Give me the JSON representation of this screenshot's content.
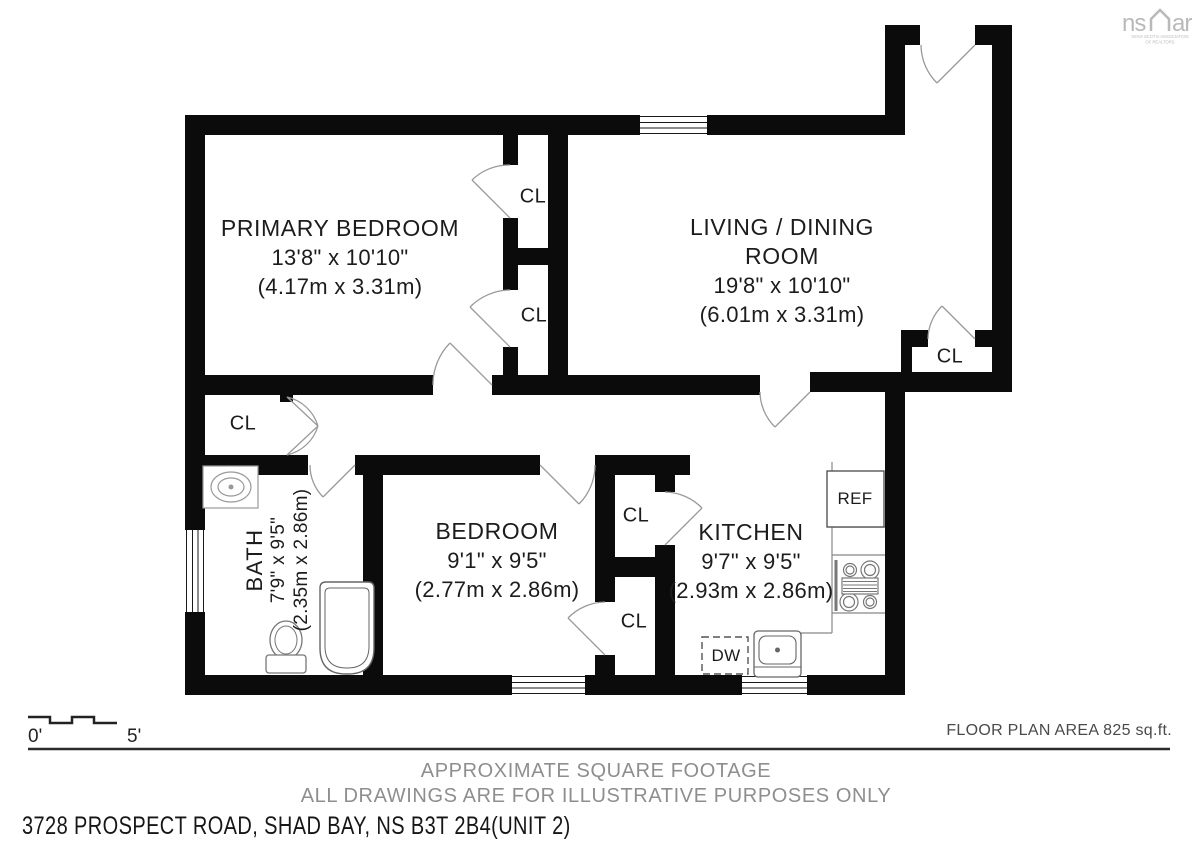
{
  "logo": {
    "left": "ns",
    "right": "ar",
    "sub1": "NOVA SCOTIA ASSOCIATION",
    "sub2": "OF REALTORS"
  },
  "rooms": {
    "primary_bedroom": {
      "name": "PRIMARY BEDROOM",
      "imperial": "13'8\" x 10'10\"",
      "metric": "(4.17m x 3.31m)"
    },
    "living_dining": {
      "name_line1": "LIVING / DINING",
      "name_line2": "ROOM",
      "imperial": "19'8\" x 10'10\"",
      "metric": "(6.01m x 3.31m)"
    },
    "bedroom": {
      "name": "BEDROOM",
      "imperial": "9'1\" x 9'5\"",
      "metric": "(2.77m x 2.86m)"
    },
    "kitchen": {
      "name": "KITCHEN",
      "imperial": "9'7\" x 9'5\"",
      "metric": "(2.93m x 2.86m)"
    },
    "bath": {
      "name": "BATH",
      "imperial": "7'9\" x 9'5\"",
      "metric": "(2.35m x 2.86m)"
    }
  },
  "labels": {
    "closet": "CL",
    "fridge": "REF",
    "dishwasher": "DW"
  },
  "scale": {
    "start": "0'",
    "end": "5'"
  },
  "footer": {
    "area": "FLOOR PLAN AREA 825 sq.ft.",
    "note1": "APPROXIMATE SQUARE FOOTAGE",
    "note2": "ALL DRAWINGS ARE FOR ILLUSTRATIVE PURPOSES ONLY",
    "address": "3728 PROSPECT ROAD, SHAD BAY, NS B3T 2B4(UNIT 2)"
  }
}
